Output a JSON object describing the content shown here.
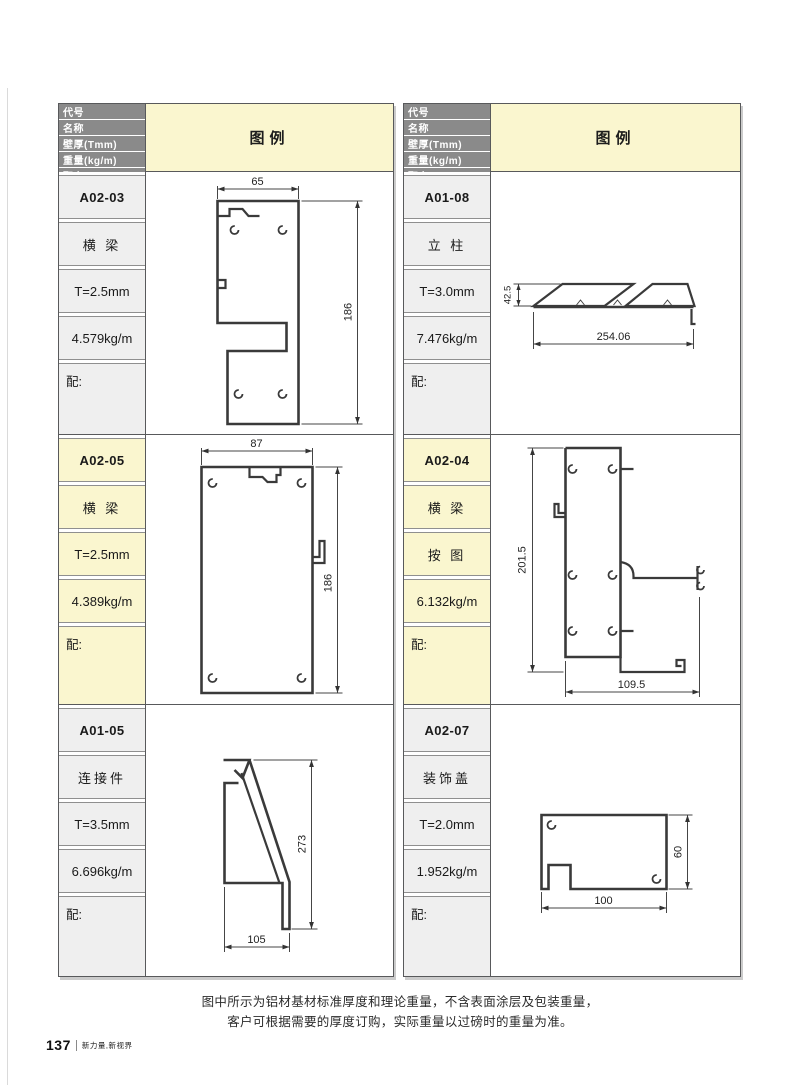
{
  "header": {
    "labels": [
      "代号",
      "名称",
      "壁厚(Tmm)",
      "重量(kg/m)",
      "配套"
    ],
    "legend": "图例"
  },
  "columns": [
    {
      "rows": [
        {
          "code": "A02-03",
          "name": "横 梁",
          "thickness": "T=2.5mm",
          "weight": "4.579kg/m",
          "fit": "配:",
          "highlight": false,
          "dims": {
            "w": "65",
            "h": "186"
          }
        },
        {
          "code": "A02-05",
          "name": "横 梁",
          "thickness": "T=2.5mm",
          "weight": "4.389kg/m",
          "fit": "配:",
          "highlight": true,
          "dims": {
            "w": "87",
            "h": "186"
          }
        },
        {
          "code": "A01-05",
          "name": "连接件",
          "thickness": "T=3.5mm",
          "weight": "6.696kg/m",
          "fit": "配:",
          "highlight": false,
          "dims": {
            "w": "105",
            "h": "273"
          }
        }
      ]
    },
    {
      "rows": [
        {
          "code": "A01-08",
          "name": "立 柱",
          "thickness": "T=3.0mm",
          "weight": "7.476kg/m",
          "fit": "配:",
          "highlight": false,
          "dims": {
            "w": "254.06",
            "h": "42.5"
          }
        },
        {
          "code": "A02-04",
          "name": "横 梁",
          "thickness": "按 图",
          "weight": "6.132kg/m",
          "fit": "配:",
          "highlight": true,
          "dims": {
            "w": "109.5",
            "h": "201.5"
          }
        },
        {
          "code": "A02-07",
          "name": "装饰盖",
          "thickness": "T=2.0mm",
          "weight": "1.952kg/m",
          "fit": "配:",
          "highlight": false,
          "dims": {
            "w": "100",
            "h": "60"
          }
        }
      ]
    }
  ],
  "note": {
    "line1": "图中所示为铝材基材标准厚度和理论重量，不含表面涂层及包装重量，",
    "line2": "客户可根据需要的厚度订购，实际重量以过磅时的重量为准。"
  },
  "footer": {
    "page_number": "137",
    "slogan": "新力量,新视界"
  },
  "colors": {
    "accent_yellow": "#FAF6CF",
    "header_gray": "#8A8A8A",
    "cell_gray": "#EFEFEF",
    "line": "#3A3A3A"
  }
}
